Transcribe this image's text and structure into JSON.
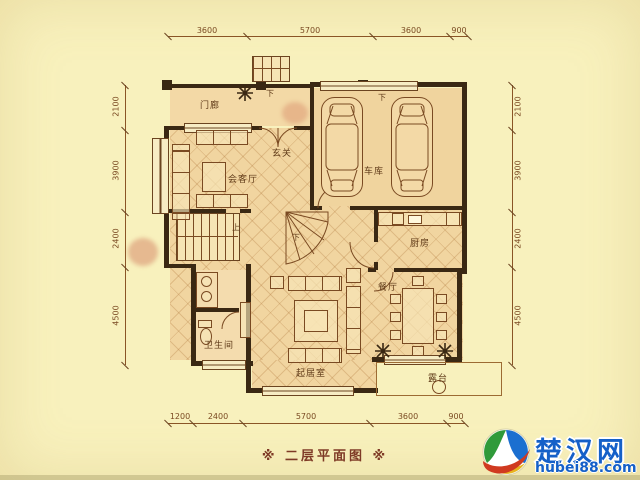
{
  "page": {
    "caption": "※ 二层平面图 ※"
  },
  "plan": {
    "rooms": {
      "porch": "门廊",
      "foyer": "玄关",
      "reception": "会客厅",
      "garage": "车库",
      "kitchen": "厨房",
      "dining": "餐厅",
      "bathroom": "卫生间",
      "living": "起居室",
      "terrace": "露台"
    },
    "annotations": {
      "down": "下",
      "up": "上"
    },
    "dims": {
      "top": [
        "3600",
        "5700",
        "3600",
        "900"
      ],
      "bottom": [
        "1200",
        "2400",
        "5700",
        "3600",
        "900"
      ],
      "left": [
        "2100",
        "3900",
        "2400",
        "4500"
      ],
      "right": [
        "2100",
        "3900",
        "2400",
        "4500"
      ]
    }
  },
  "watermark": {
    "name": "楚汉网",
    "url": "hubei88.com"
  }
}
